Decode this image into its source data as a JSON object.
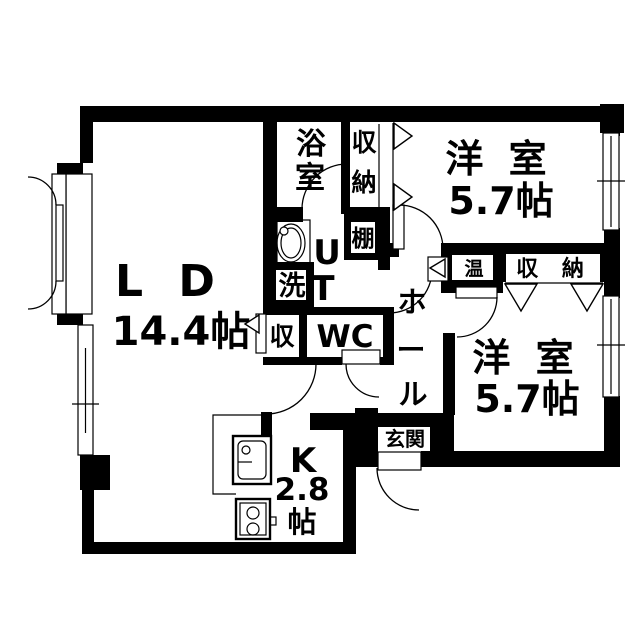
{
  "title": "apartment-floor-plan",
  "colors": {
    "wall": "#000000",
    "background": "#ffffff"
  },
  "rooms": {
    "living_dining": {
      "name": "L D",
      "size": "14.4帖"
    },
    "kitchen": {
      "name": "K",
      "size": "2.8",
      "unit": "帖"
    },
    "bath": {
      "label": "浴室",
      "char1": "浴",
      "char2": "室"
    },
    "closet_north": {
      "label": "収納",
      "char1": "収",
      "char2": "納"
    },
    "western_room_north": {
      "name": "洋 室",
      "size": "5.7帖"
    },
    "western_room_south": {
      "name": "洋 室",
      "size": "5.7帖"
    },
    "shelf": {
      "label": "棚"
    },
    "utility": {
      "label": "UT",
      "char1": "U",
      "char2": "T"
    },
    "laundry": {
      "label": "洗"
    },
    "toilet": {
      "label": "WC"
    },
    "storage": {
      "label": "収"
    },
    "hall": {
      "label": "ホール",
      "char1": "ホ",
      "char2": "ー",
      "char3": "ル"
    },
    "heater": {
      "label": "温"
    },
    "closet_south": {
      "label": "収 納"
    },
    "entrance": {
      "label": "玄関"
    }
  }
}
